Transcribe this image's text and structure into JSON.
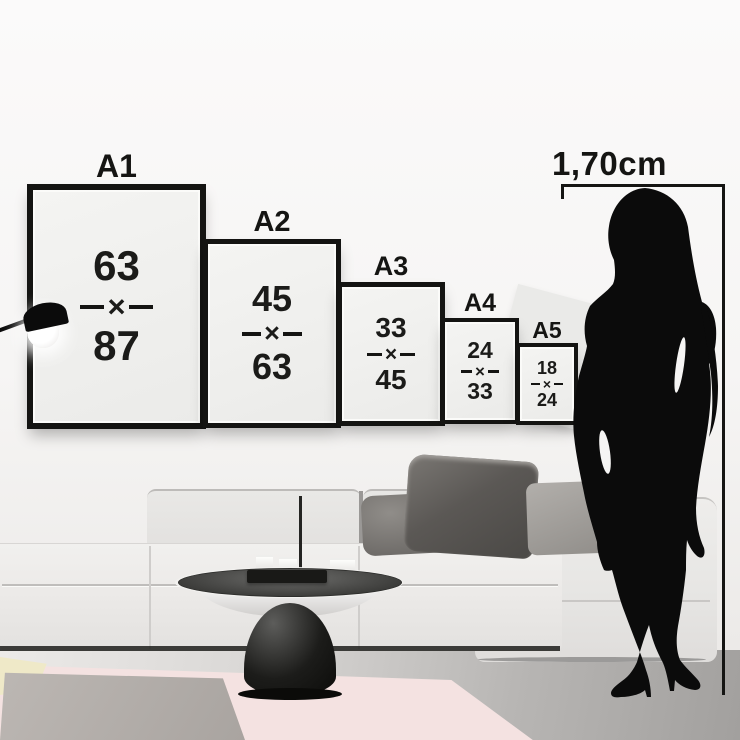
{
  "measurement": {
    "height_label": "1,70cm"
  },
  "separator": "×",
  "frames": [
    {
      "label": "A1",
      "width": "63",
      "height": "87"
    },
    {
      "label": "A2",
      "width": "45",
      "height": "63"
    },
    {
      "label": "A3",
      "width": "33",
      "height": "45"
    },
    {
      "label": "A4",
      "width": "24",
      "height": "33"
    },
    {
      "label": "A5",
      "width": "18",
      "height": "24"
    }
  ],
  "colors": {
    "frame_black": "#141412",
    "poster_gray": "#f0f0ee",
    "wall": "#f7f6f5",
    "floor_gray": "#c9c7c5",
    "rug_pink": "#f4e2e1",
    "rug_gray": "#b1aca8",
    "rug_yellow": "#efe9c8",
    "couch_light_gray": "#ebeae8",
    "pillow_dark_gray": "#565350",
    "silhouette_black": "#0b0b0b"
  }
}
